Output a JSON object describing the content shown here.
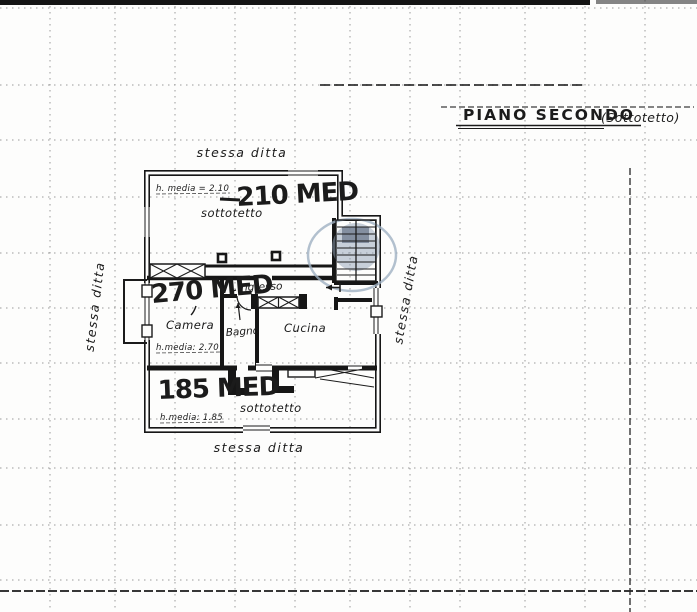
{
  "colors": {
    "paper": "#fdfdfc",
    "ink": "#1b1b1b",
    "stamp": "#92a1b5"
  },
  "title": {
    "main": "PIANO SECONDO",
    "suffix": "(Sottotetto)"
  },
  "boundaries": {
    "top": "stessa ditta",
    "bottom": "stessa ditta",
    "left": "stessa ditta",
    "right": "stessa ditta"
  },
  "rooms": {
    "attic_top": "sottotetto",
    "attic_bottom": "sottotetto",
    "bedroom": "Camera",
    "bath": "Bagno",
    "kitchen": "Cucina",
    "entry": "Ingresso"
  },
  "measures": {
    "top": {
      "big": "210 MED",
      "note": "h. media = 2.10"
    },
    "middle": {
      "big": "270 MED",
      "note": "h.media: 2.70"
    },
    "bottom": {
      "big": "185 MED",
      "note": "h.media: 1.85"
    }
  }
}
